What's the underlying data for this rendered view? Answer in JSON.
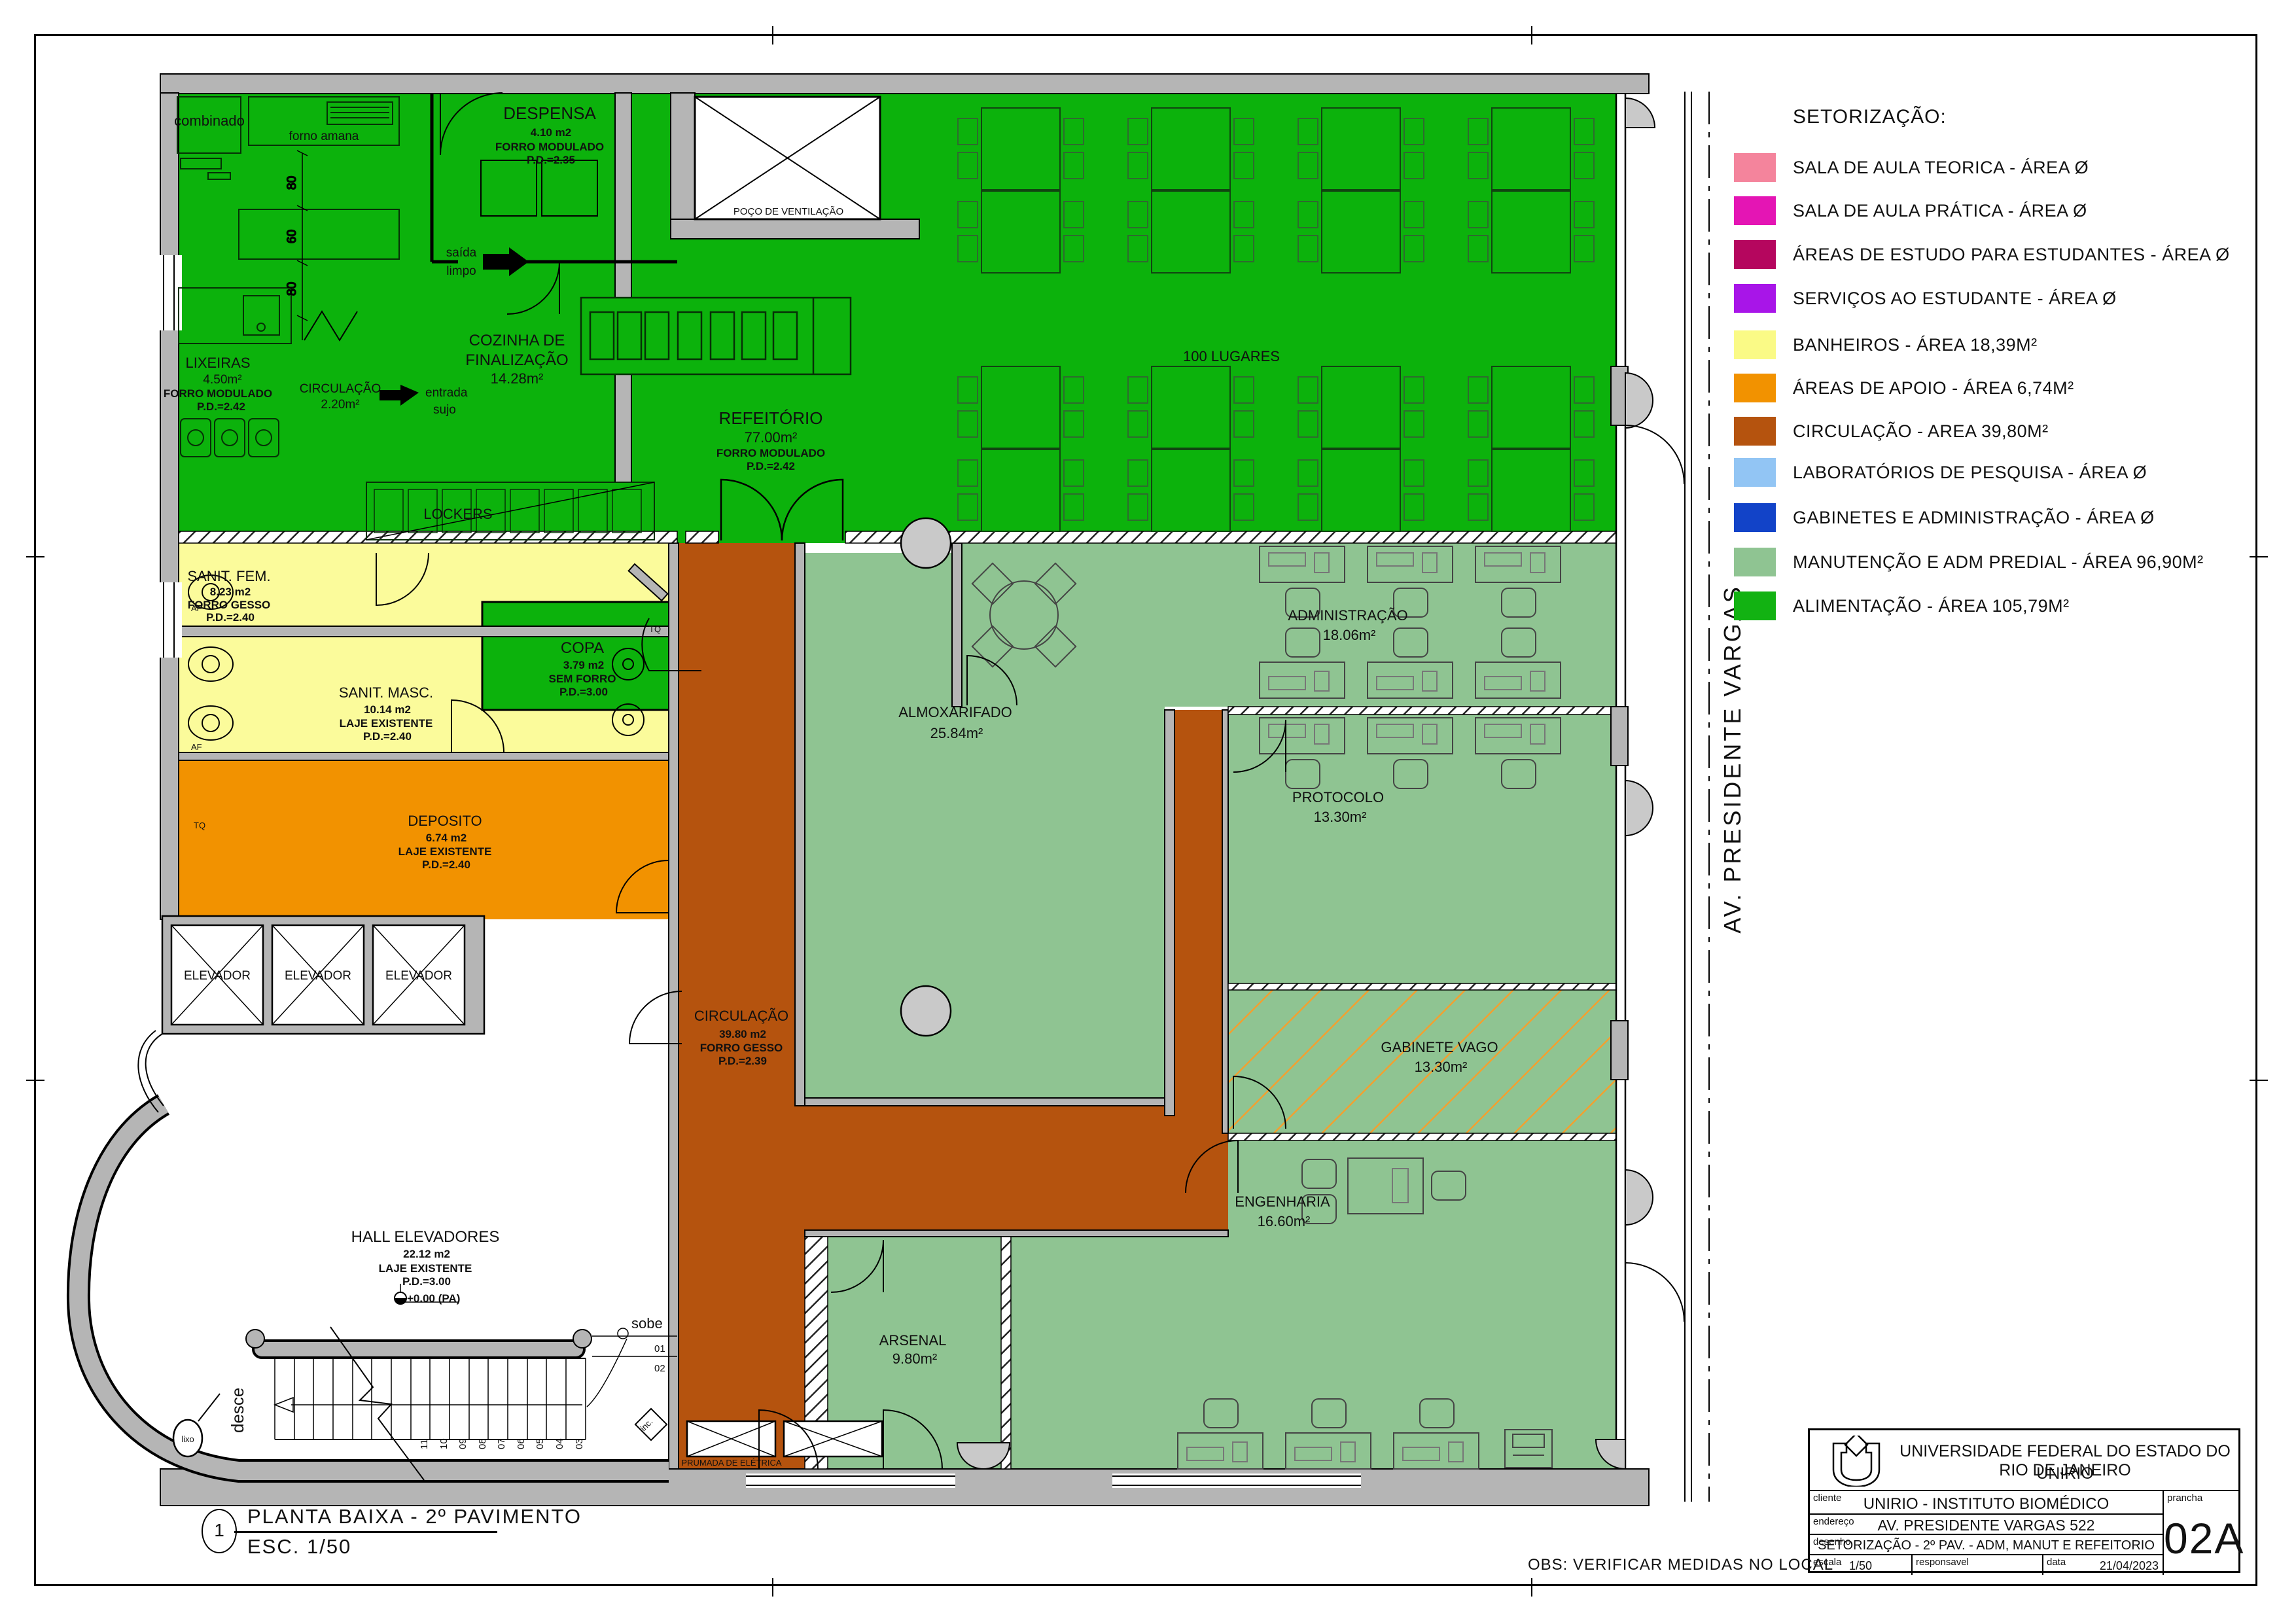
{
  "colors": {
    "green": "#0cb20c",
    "light_green": "#8fc492",
    "yellow": "#fbfb9b",
    "orange": "#f29200",
    "brown": "#b5530e",
    "wall_gray": "#b5b5b5"
  },
  "legend": {
    "title": "SETORIZAÇÃO:",
    "items": [
      {
        "label": "SALA DE AULA TEORICA - ÁREA Ø",
        "color": "#f4849c"
      },
      {
        "label": "SALA DE AULA PRÁTICA - ÁREA Ø",
        "color": "#e415b4"
      },
      {
        "label": "ÁREAS DE ESTUDO PARA ESTUDANTES - ÁREA Ø",
        "color": "#b5065e"
      },
      {
        "label": "SERVIÇOS AO ESTUDANTE - ÁREA Ø",
        "color": "#a815e8"
      },
      {
        "label": "BANHEIROS - ÁREA 18,39M²",
        "color": "#fafa86"
      },
      {
        "label": "ÁREAS DE APOIO - ÁREA 6,74M²",
        "color": "#f29200"
      },
      {
        "label": "CIRCULAÇÃO  - AREA 39,80M²",
        "color": "#b5530e"
      },
      {
        "label": "LABORATÓRIOS DE PESQUISA - ÁREA Ø",
        "color": "#92c5f4"
      },
      {
        "label": "GABINETES E ADMINISTRAÇÃO - ÁREA Ø",
        "color": "#1243c8"
      },
      {
        "label": "MANUTENÇÃO E ADM PREDIAL - ÁREA 96,90M²",
        "color": "#8fc492"
      },
      {
        "label": "ALIMENTAÇÃO - ÁREA 105,79M²",
        "color": "#12b212"
      }
    ]
  },
  "plan": {
    "rooms": {
      "despensa": [
        "DESPENSA",
        "4.10 m2",
        "FORRO MODULADO",
        "P.D.=2.35"
      ],
      "cozinha": [
        "COZINHA DE",
        "FINALIZAÇÃO",
        "14.28m²"
      ],
      "lixeiras": [
        "LIXEIRAS",
        "4.50m²",
        "FORRO MODULADO",
        "P.D.=2.42"
      ],
      "circ_serv": [
        "CIRCULAÇÃO",
        "2.20m²"
      ],
      "refeitorio": [
        "REFEITÓRIO",
        "77.00m²",
        "FORRO MODULADO",
        "P.D.=2.42"
      ],
      "sanit_fem": [
        "SANIT. FEM.",
        "8.23 m2",
        "FORRO GESSO",
        "P.D.=2.40"
      ],
      "sanit_masc": [
        "SANIT. MASC.",
        "10.14 m2",
        "LAJE EXISTENTE",
        "P.D.=2.40"
      ],
      "copa": [
        "COPA",
        "3.79 m2",
        "SEM FORRO",
        "P.D.=3.00"
      ],
      "deposito": [
        "DEPOSITO",
        "6.74 m2",
        "LAJE EXISTENTE",
        "P.D.=2.40"
      ],
      "hall": [
        "HALL ELEVADORES",
        "22.12 m2",
        "LAJE EXISTENTE",
        "P.D.=3.00",
        "+0.00  (PA)"
      ],
      "circulacao": [
        "CIRCULAÇÃO",
        "39.80 m2",
        "FORRO GESSO",
        "P.D.=2.39"
      ],
      "almoxarifado": [
        "ALMOXARIFADO",
        "25.84m²"
      ],
      "administracao": [
        "ADMINISTRAÇÃO",
        "18.06m²"
      ],
      "protocolo": [
        "PROTOCOLO",
        "13.30m²"
      ],
      "gabinete": [
        "GABINETE VAGO",
        "13.30m²"
      ],
      "engenharia": [
        "ENGENHARIA",
        "16.60m²"
      ],
      "arsenal": [
        "ARSENAL",
        "9.80m²"
      ],
      "elevador": "ELEVADOR",
      "poco": "POÇO DE VENTILAÇÃO",
      "lockers": "LOCKERS",
      "prumada": "PRUMADA DE ELÉTRICA"
    },
    "annotations": {
      "combinado": "combinado",
      "forno": "forno amana",
      "saida": [
        "saída",
        "limpo"
      ],
      "entrada": [
        "entrada",
        "sujo"
      ],
      "lugares": "100 LUGARES",
      "af": "AF",
      "tq": "TQ",
      "dims": [
        "80",
        "60",
        "80"
      ],
      "street": "AV. PRESIDENTE VARGAS"
    },
    "stairs": {
      "sobe": "sobe",
      "desce": "desce",
      "inc": "inc.",
      "lixo": "lixo",
      "steps": [
        "01",
        "02",
        "03",
        "04",
        "05",
        "06",
        "07",
        "08",
        "09",
        "10",
        "11"
      ]
    }
  },
  "sheet": {
    "number": "1",
    "title": "PLANTA BAIXA - 2º PAVIMENTO",
    "scale": "ESC. 1/50",
    "obs": "OBS: VERIFICAR MEDIDAS NO LOCAL"
  },
  "titleblock": {
    "org1": "UNIVERSIDADE FEDERAL DO ESTADO DO RIO DE JANEIRO",
    "org2": "UNIRIO",
    "cliente_label": "cliente",
    "cliente": "UNIRIO - INSTITUTO BIOMÉDICO",
    "endereco_label": "endereço",
    "endereco": "AV. PRESIDENTE VARGAS 522",
    "desenho_label": "desenho",
    "desenho": "SETORIZAÇÃO - 2º PAV. - ADM, MANUT E REFEITORIO",
    "escala_label": "escala",
    "escala": "1/50",
    "resp_label": "responsavel",
    "data_label": "data",
    "data": "21/04/2023",
    "prancha_label": "prancha",
    "prancha": "02A"
  }
}
